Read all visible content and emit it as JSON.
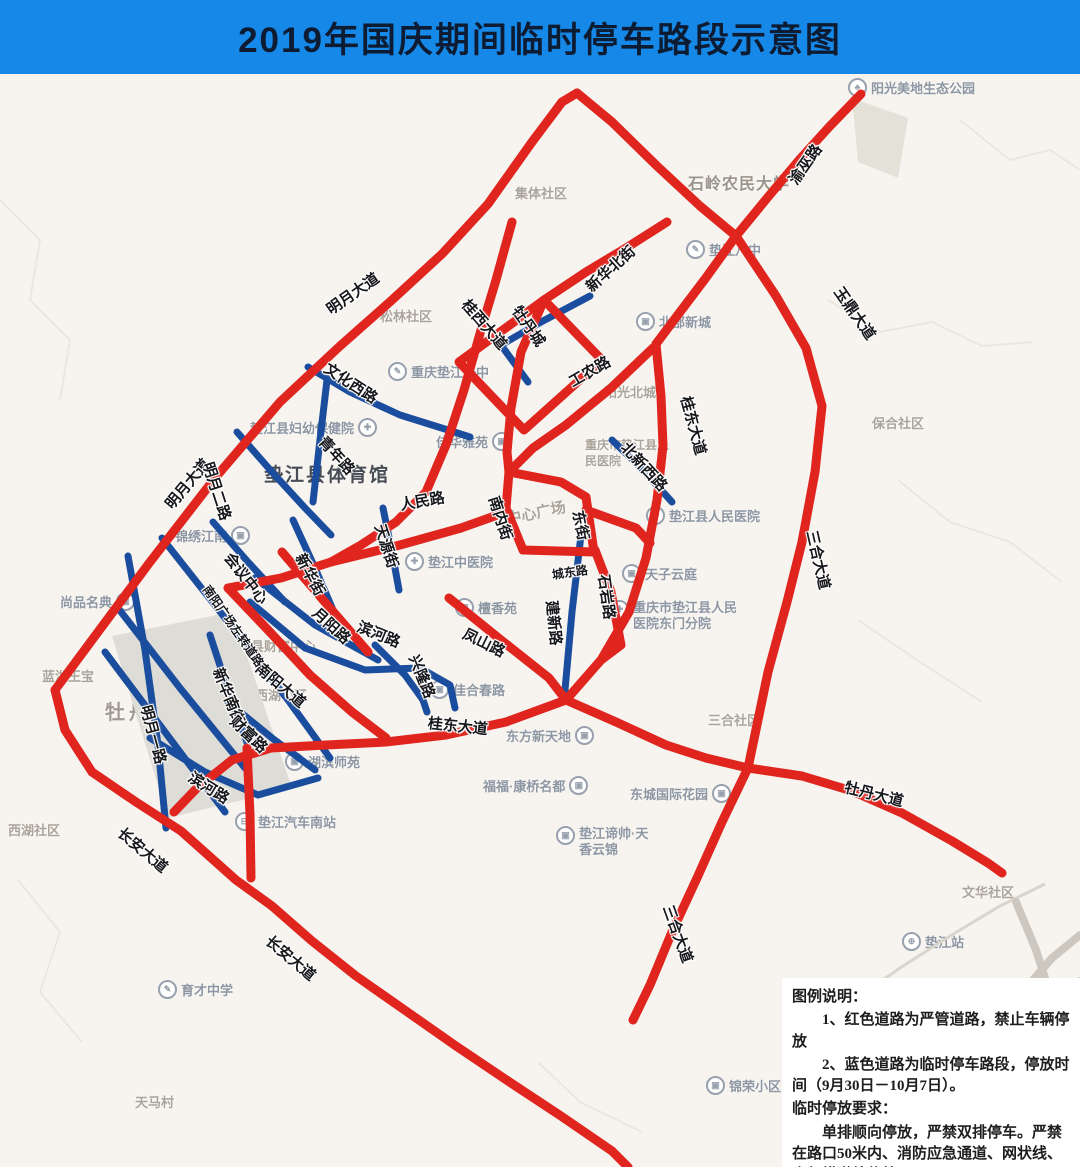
{
  "title": "2019年国庆期间临时停车路段示意图",
  "colors": {
    "title_bg": "#1689e8",
    "restricted_red": "#e0251f",
    "temp_parking_blue": "#1b4d9e",
    "map_bg": "#f7f4ef"
  },
  "legend": {
    "lines": [
      "图例说明：",
      "1、红色道路为严管道路，禁止车辆停放",
      "2、蓝色道路为临时停车路段，停放时间（9月30日－10月7日）。",
      "临时停放要求：",
      "单排顺向停放，严禁双排停车。严禁在路口50米内、消防应急通道、网状线、人行横道处停放。"
    ]
  },
  "map": {
    "road_labels": {
      "yuwu": {
        "text": "渝巫路"
      },
      "yuding": {
        "text": "玉鼎大道"
      },
      "mingyue_ave_1": {
        "text": "明月大道"
      },
      "mingyue_ave_2": {
        "text": "明月大道"
      },
      "wenhua_w": {
        "text": "文化西路"
      },
      "xinhua_n": {
        "text": "新华北街"
      },
      "guixi": {
        "text": "桂西大道"
      },
      "gongnong": {
        "text": "工农路"
      },
      "guidong_n": {
        "text": "桂东大道"
      },
      "guidong_w": {
        "text": "桂东大道"
      },
      "mudancheng": {
        "text": "牡丹城"
      },
      "beixin_w": {
        "text": "北新西路"
      },
      "qingnian": {
        "text": "青年路"
      },
      "mingyue_2nd": {
        "text": "明月二路"
      },
      "renmin": {
        "text": "人民路"
      },
      "nannei": {
        "text": "南内街"
      },
      "dongjie": {
        "text": "东街"
      },
      "chengdong": {
        "text": "城东路"
      },
      "shiyan": {
        "text": "石岩路"
      },
      "jianxin": {
        "text": "建新路"
      },
      "tianyuan": {
        "text": "天源街"
      },
      "xinhua_st": {
        "text": "新华街"
      },
      "yueyang": {
        "text": "月阳路"
      },
      "binhe_1": {
        "text": "滨河路"
      },
      "binhe_2": {
        "text": "滨河路"
      },
      "fengshan": {
        "text": "凤山路"
      },
      "xinglong": {
        "text": "兴隆路"
      },
      "nanyang_ave": {
        "text": "南阳大道"
      },
      "nanyang_plaza": {
        "text": "南阳广场左转道路"
      },
      "huiyi": {
        "text": "会议中心"
      },
      "mingyue_1st": {
        "text": "明月一路"
      },
      "xinhua_s": {
        "text": "新华南街"
      },
      "caifu": {
        "text": "财富路"
      },
      "sanhe_1": {
        "text": "三合大道"
      },
      "sanhe_2": {
        "text": "三合大道"
      },
      "mudan_ave": {
        "text": "牡丹大道"
      },
      "changan_1": {
        "text": "长安大道"
      },
      "changan_2": {
        "text": "长安大道"
      }
    },
    "place_labels": {
      "jiti": {
        "text": "集体社区"
      },
      "songlin": {
        "text": "松林社区"
      },
      "shiling": {
        "text": "石岭农民大学"
      },
      "baohe": {
        "text": "保合社区"
      },
      "yangguang_bc": {
        "text": "阳光北城"
      },
      "xihu": {
        "text": "西湖社区"
      },
      "sanhe_sq": {
        "text": "三合社区"
      },
      "wenhua_sq": {
        "text": "文华社区"
      },
      "tianma": {
        "text": "天马村"
      },
      "mudanhu": {
        "text": "牡丹湖"
      },
      "lanhu": {
        "text": "蓝湖王宝"
      },
      "zhongxin": {
        "text": "中心广场"
      },
      "caifu_center": {
        "text": "垫江县财富中心"
      },
      "yangxihu": {
        "text": "阳西湖小区"
      },
      "tiyuguan": {
        "text": "垫江县体育馆"
      },
      "renmin_hosp_back": {
        "text": "重庆市垫江县人民医院"
      }
    },
    "pois": {
      "yangguang_park": {
        "text": "阳光美地生态公园",
        "icon": "park"
      },
      "dianjiang8": {
        "text": "垫江八中",
        "icon": "school"
      },
      "beibu": {
        "text": "北部新城",
        "icon": "building"
      },
      "yizhong": {
        "text": "重庆垫江一中",
        "icon": "school"
      },
      "jiahua": {
        "text": "佳华雅苑",
        "icon": "building"
      },
      "fuyou": {
        "text": "垫江县妇幼保健院",
        "icon": "hospital"
      },
      "zhongyi": {
        "text": "垫江中医院",
        "icon": "hospital"
      },
      "tanxiang": {
        "text": "檀香苑",
        "icon": "building"
      },
      "tianzi": {
        "text": "天子云庭",
        "icon": "building"
      },
      "renmin_hosp": {
        "text": "垫江县人民医院",
        "icon": "hospital"
      },
      "dongmen": {
        "text": "重庆市垫江县人民医院东门分院",
        "icon": "hospital"
      },
      "jinxiu": {
        "text": "锦绣江南",
        "icon": "building"
      },
      "shangpin": {
        "text": "尚品名典",
        "icon": "building"
      },
      "hubin": {
        "text": "湖滨师苑",
        "icon": "building"
      },
      "qiche": {
        "text": "垫江汽车南站",
        "icon": "bus"
      },
      "dongfang": {
        "text": "东方新天地",
        "icon": "building"
      },
      "fufu": {
        "text": "福福·康桥名都",
        "icon": "building"
      },
      "dongcheng": {
        "text": "东城国际花园",
        "icon": "building"
      },
      "dishuai": {
        "text": "垫江谛帅·天香云锦",
        "icon": "building"
      },
      "yucai": {
        "text": "育才中学",
        "icon": "school"
      },
      "station": {
        "text": "垫江站",
        "icon": "train"
      },
      "jinrong": {
        "text": "锦荣小区",
        "icon": "building"
      },
      "jiahe": {
        "text": "佳合春路",
        "icon": "building"
      }
    }
  }
}
